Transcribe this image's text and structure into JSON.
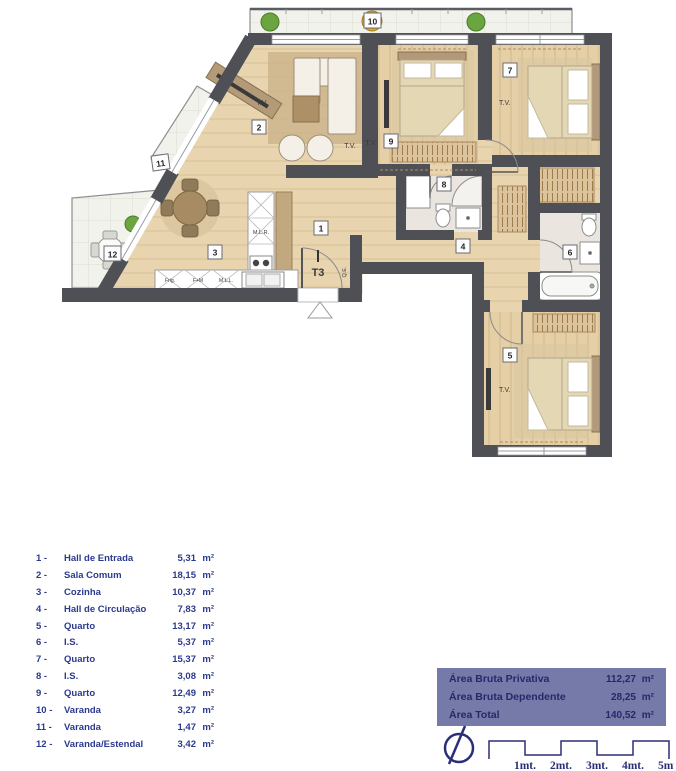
{
  "plan": {
    "tags": {
      "t1": "1",
      "t2": "2",
      "t3": "3",
      "t4": "4",
      "t5": "5",
      "t6": "6",
      "t7": "7",
      "t8": "8",
      "t9": "9",
      "t10": "10",
      "t11": "11",
      "t12": "12"
    },
    "labels": {
      "tv": "T.V.",
      "unit": "T3",
      "electrical": "Q.E.",
      "washing_machine": "M.L.R.",
      "fridge": "Frig.",
      "oven_micro": "F+M",
      "dishwasher": "M.L.L."
    }
  },
  "legend": {
    "rows": [
      {
        "num": "1 -",
        "label": "Hall de Entrada",
        "value": "5,31",
        "unit": "m²"
      },
      {
        "num": "2 -",
        "label": "Sala Comum",
        "value": "18,15",
        "unit": "m²"
      },
      {
        "num": "3 -",
        "label": "Cozinha",
        "value": "10,37",
        "unit": "m²"
      },
      {
        "num": "4 -",
        "label": "Hall de Circulação",
        "value": "7,83",
        "unit": "m²"
      },
      {
        "num": "5 -",
        "label": "Quarto",
        "value": "13,17",
        "unit": "m²"
      },
      {
        "num": "6 -",
        "label": "I.S.",
        "value": "5,37",
        "unit": "m²"
      },
      {
        "num": "7 -",
        "label": "Quarto",
        "value": "15,37",
        "unit": "m²"
      },
      {
        "num": "8 -",
        "label": "I.S.",
        "value": "3,08",
        "unit": "m²"
      },
      {
        "num": "9 -",
        "label": "Quarto",
        "value": "12,49",
        "unit": "m²"
      },
      {
        "num": "10 -",
        "label": "Varanda",
        "value": "3,27",
        "unit": "m²"
      },
      {
        "num": "11 -",
        "label": "Varanda",
        "value": "1,47",
        "unit": "m²"
      },
      {
        "num": "12 -",
        "label": "Varanda/Estendal",
        "value": "3,42",
        "unit": "m²"
      }
    ]
  },
  "summary": {
    "rows": [
      {
        "label": "Área Bruta Privativa",
        "value": "112,27",
        "unit": "m²"
      },
      {
        "label": "Área Bruta Dependente",
        "value": "28,25",
        "unit": "m²"
      },
      {
        "label": "Área Total",
        "value": "140,52",
        "unit": "m²"
      }
    ]
  },
  "scale": {
    "labels": [
      "1mt.",
      "2mt.",
      "3mt.",
      "4mt.",
      "5mt."
    ]
  },
  "colors": {
    "wall": "#4e5055",
    "wood": "#e8d5af",
    "balcony": "#f1f2ec",
    "stone": "#eae6df",
    "legend_text": "#2c3a8e",
    "panel": "#767aa9",
    "panel_text": "#23296b",
    "hatch": "#dcc39b"
  }
}
